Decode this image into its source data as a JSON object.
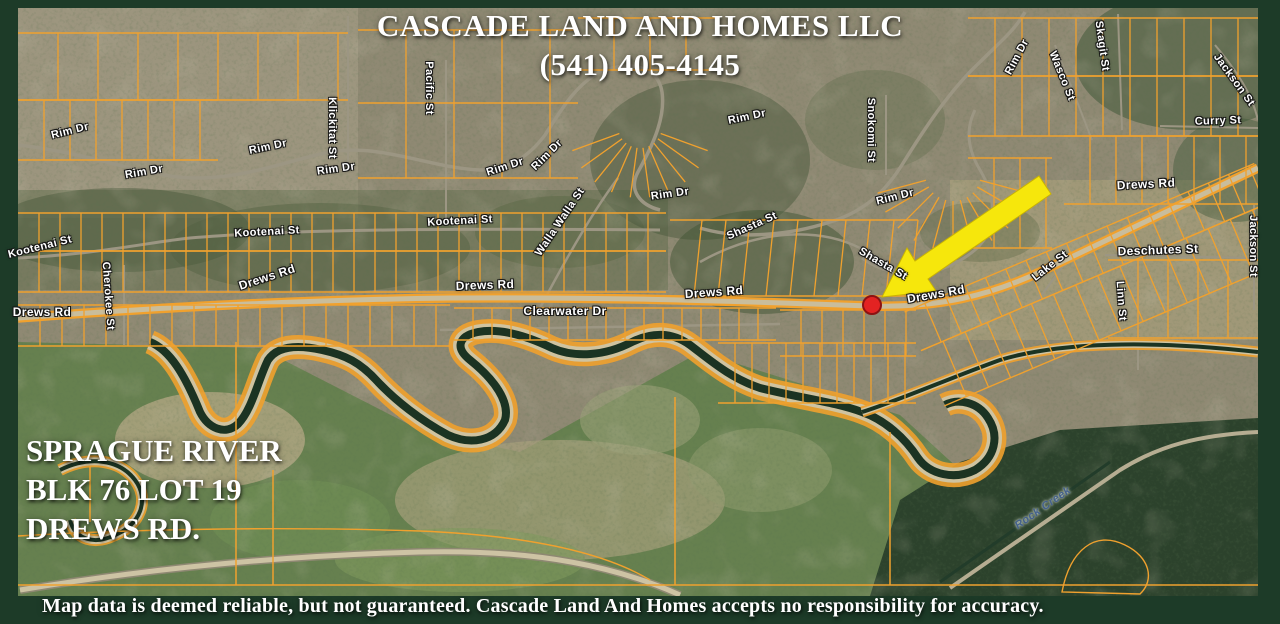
{
  "header": {
    "company_name": "CASCADE LAND AND HOMES LLC",
    "phone": "(541) 405-4145"
  },
  "property_info": {
    "line1": "SPRAGUE RIVER",
    "line2": "BLK 76 LOT 19",
    "line3": "DREWS RD."
  },
  "footer": {
    "disclaimer": "Map data is deemed reliable, but not guaranteed. Cascade Land And Homes accepts no responsibility for accuracy."
  },
  "marker": {
    "shape": "red-dot",
    "x": 872,
    "y": 305
  },
  "arrow": {
    "shape": "yellow-arrow",
    "tail_x": 1045,
    "tail_y": 185,
    "tip_x": 882,
    "tip_y": 297
  },
  "colors": {
    "frame_green": "#1d3b28",
    "parcel_line": "#f0a12e",
    "arrow_yellow": "#f6e70c",
    "marker_red": "#e32322",
    "street_label_text": "#ffffff",
    "water_label_text": "#44618c"
  },
  "street_labels": [
    {
      "name": "Rim Dr",
      "x": 70,
      "y": 131,
      "rot": -14,
      "s": 11
    },
    {
      "name": "Rim Dr",
      "x": 144,
      "y": 172,
      "rot": -10,
      "s": 11
    },
    {
      "name": "Rim Dr",
      "x": 268,
      "y": 147,
      "rot": -12,
      "s": 11
    },
    {
      "name": "Rim Dr",
      "x": 336,
      "y": 169,
      "rot": -8,
      "s": 11
    },
    {
      "name": "Rim Dr",
      "x": 505,
      "y": 167,
      "rot": -18,
      "s": 11
    },
    {
      "name": "Rim Dr",
      "x": 547,
      "y": 155,
      "rot": -45,
      "s": 11
    },
    {
      "name": "Rim Dr",
      "x": 670,
      "y": 194,
      "rot": -8,
      "s": 11
    },
    {
      "name": "Rim Dr",
      "x": 747,
      "y": 117,
      "rot": -12,
      "s": 11
    },
    {
      "name": "Rim Dr",
      "x": 895,
      "y": 197,
      "rot": -14,
      "s": 11
    },
    {
      "name": "Rim Dr",
      "x": 1017,
      "y": 57,
      "rot": -62,
      "s": 11
    },
    {
      "name": "Klickitat St",
      "x": 332,
      "y": 128,
      "rot": 90,
      "s": 11
    },
    {
      "name": "Pacific St",
      "x": 429,
      "y": 88,
      "rot": 90,
      "s": 11
    },
    {
      "name": "Snokomi St",
      "x": 871,
      "y": 130,
      "rot": 90,
      "s": 11
    },
    {
      "name": "Wasco St",
      "x": 1062,
      "y": 76,
      "rot": 68,
      "s": 11
    },
    {
      "name": "Skagit St",
      "x": 1102,
      "y": 46,
      "rot": 82,
      "s": 11
    },
    {
      "name": "Jackson St",
      "x": 1234,
      "y": 80,
      "rot": 54,
      "s": 11
    },
    {
      "name": "Jackson St",
      "x": 1253,
      "y": 246,
      "rot": 90,
      "s": 11
    },
    {
      "name": "Curry St",
      "x": 1218,
      "y": 121,
      "rot": -2,
      "s": 11
    },
    {
      "name": "Kootenai St",
      "x": 40,
      "y": 247,
      "rot": -14,
      "s": 11
    },
    {
      "name": "Kootenai St",
      "x": 267,
      "y": 232,
      "rot": -3,
      "s": 11
    },
    {
      "name": "Kootenai St",
      "x": 460,
      "y": 221,
      "rot": -3,
      "s": 11
    },
    {
      "name": "Cherokee St",
      "x": 108,
      "y": 296,
      "rot": 86,
      "s": 11
    },
    {
      "name": "Walla Walla St",
      "x": 560,
      "y": 222,
      "rot": -56,
      "s": 11
    },
    {
      "name": "Shasta St",
      "x": 752,
      "y": 226,
      "rot": -24,
      "s": 11
    },
    {
      "name": "Shasta St",
      "x": 883,
      "y": 264,
      "rot": 30,
      "s": 11
    },
    {
      "name": "Lake St",
      "x": 1050,
      "y": 266,
      "rot": -38,
      "s": 11
    },
    {
      "name": "Deschutes St",
      "x": 1158,
      "y": 250,
      "rot": -2,
      "s": 12
    },
    {
      "name": "Linn St",
      "x": 1121,
      "y": 301,
      "rot": 86,
      "s": 11
    },
    {
      "name": "Drews Rd",
      "x": 42,
      "y": 312,
      "rot": 0,
      "s": 12
    },
    {
      "name": "Drews Rd",
      "x": 267,
      "y": 277,
      "rot": -18,
      "s": 12
    },
    {
      "name": "Drews Rd",
      "x": 485,
      "y": 285,
      "rot": -2,
      "s": 12
    },
    {
      "name": "Drews Rd",
      "x": 714,
      "y": 292,
      "rot": -4,
      "s": 12
    },
    {
      "name": "Drews Rd",
      "x": 936,
      "y": 294,
      "rot": -10,
      "s": 12
    },
    {
      "name": "Drews Rd",
      "x": 1146,
      "y": 184,
      "rot": -3,
      "s": 12
    },
    {
      "name": "Clearwater Dr",
      "x": 565,
      "y": 311,
      "rot": 0,
      "s": 12
    }
  ],
  "water_labels": [
    {
      "name": "Rock Creek",
      "x": 1043,
      "y": 508,
      "rot": -35,
      "s": 11
    }
  ]
}
